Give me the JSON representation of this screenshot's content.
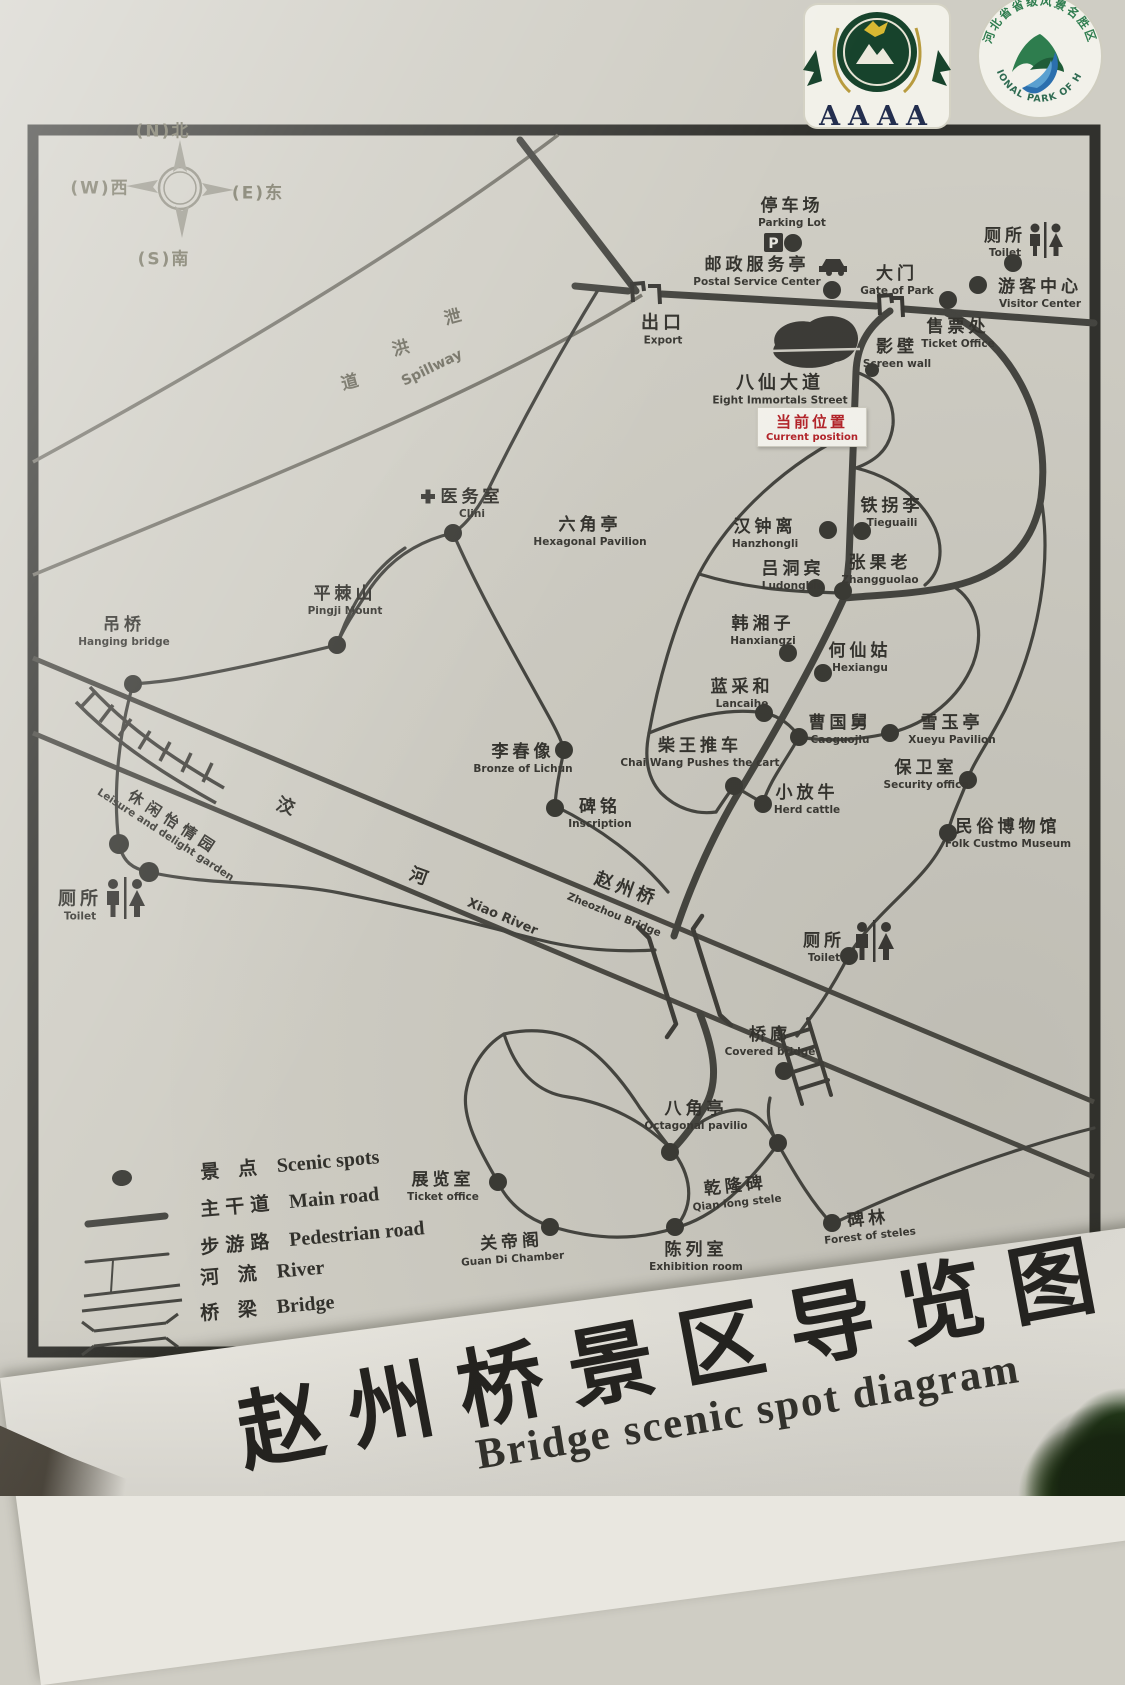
{
  "title": {
    "zh": "赵州桥景区导览图",
    "en": "Bridge scenic spot diagram"
  },
  "logos": {
    "aaaa": "AAAA",
    "hebei_top": "河北省省级风景名胜区",
    "hebei_bottom": "NATIONAL PARK OF HEBEI"
  },
  "compass": {
    "n": "(N)北",
    "w": "(W)西",
    "e": "(E)东",
    "s": "(S)南"
  },
  "current_position": {
    "zh": "当前位置",
    "en": "Current position",
    "color": "#b5242a"
  },
  "street": {
    "zh": "八仙大道",
    "en": "Eight Immortals Street"
  },
  "spillway": {
    "chars": [
      "泄",
      "洪",
      "道"
    ],
    "en": "Spillway"
  },
  "river": {
    "c1": "洨",
    "c2": "河",
    "en": "Xiao River"
  },
  "bridge_label": {
    "zh": "赵州桥",
    "en": "Zheozhou Bridge"
  },
  "icons": {
    "parking_letter": "P"
  },
  "colors": {
    "board": "#cfcdc4",
    "ink": "#34332e",
    "road": "#454540",
    "red": "#b5242a",
    "band": "#e9e7e0",
    "logo_green": "#17432c"
  },
  "spots": [
    {
      "zh": "停车场",
      "en": "Parking Lot"
    },
    {
      "zh": "邮政服务亭",
      "en": "Postal Service Center"
    },
    {
      "zh": "大门",
      "en": "Gate of Park"
    },
    {
      "zh": "厕所",
      "en": "Toilet"
    },
    {
      "zh": "游客中心",
      "en": "Visitor Center"
    },
    {
      "zh": "售票处",
      "en": "Ticket Office"
    },
    {
      "zh": "出口",
      "en": "Export"
    },
    {
      "zh": "影壁",
      "en": "Screen wall"
    },
    {
      "zh": "汉钟离",
      "en": "Hanzhongli"
    },
    {
      "zh": "铁拐李",
      "en": "Tieguaili"
    },
    {
      "zh": "吕洞宾",
      "en": "Ludongbin"
    },
    {
      "zh": "张果老",
      "en": "Zhangguolao"
    },
    {
      "zh": "韩湘子",
      "en": "Hanxiangzi"
    },
    {
      "zh": "何仙姑",
      "en": "Hexiangu"
    },
    {
      "zh": "蓝采和",
      "en": "Lancaihe"
    },
    {
      "zh": "曹国舅",
      "en": "Caoguojiu"
    },
    {
      "zh": "雪玉亭",
      "en": "Xueyu Pavilion"
    },
    {
      "zh": "柴王推车",
      "en": "Chai Wang Pushes the cart"
    },
    {
      "zh": "小放牛",
      "en": "Herd cattle"
    },
    {
      "zh": "保卫室",
      "en": "Security office"
    },
    {
      "zh": "民俗博物馆",
      "en": "Folk Custmo Museum"
    },
    {
      "zh": "李春像",
      "en": "Bronze of Lichun"
    },
    {
      "zh": "碑铭",
      "en": "Inscription"
    },
    {
      "zh": "六角亭",
      "en": "Hexagonal Pavilion"
    },
    {
      "zh": "医务室",
      "en": "Clini"
    },
    {
      "zh": "平棘山",
      "en": "Pingji Mount"
    },
    {
      "zh": "吊桥",
      "en": "Hanging bridge"
    },
    {
      "zh": "休闲怡情园",
      "en": "Leisure and delight garden"
    },
    {
      "zh": "厕所",
      "en": "Toilet"
    },
    {
      "zh": "厕所",
      "en": "Toilet"
    },
    {
      "zh": "桥廊",
      "en": "Covered bridge"
    },
    {
      "zh": "八角亭",
      "en": "Octagonal pavilio"
    },
    {
      "zh": "展览室",
      "en": "Ticket office"
    },
    {
      "zh": "关帝阁",
      "en": "Guan Di Chamber"
    },
    {
      "zh": "陈列室",
      "en": "Exhibition room"
    },
    {
      "zh": "乾隆碑",
      "en": "Qian long stele"
    },
    {
      "zh": "碑林",
      "en": "Forest of steles"
    }
  ],
  "legend": {
    "rows": [
      {
        "zh": "景 点",
        "en": "Scenic spots"
      },
      {
        "zh": "主干道",
        "en": "Main road"
      },
      {
        "zh": "步游路",
        "en": "Pedestrian road"
      },
      {
        "zh": "河 流",
        "en": "River"
      },
      {
        "zh": "桥 梁",
        "en": "Bridge"
      }
    ]
  }
}
